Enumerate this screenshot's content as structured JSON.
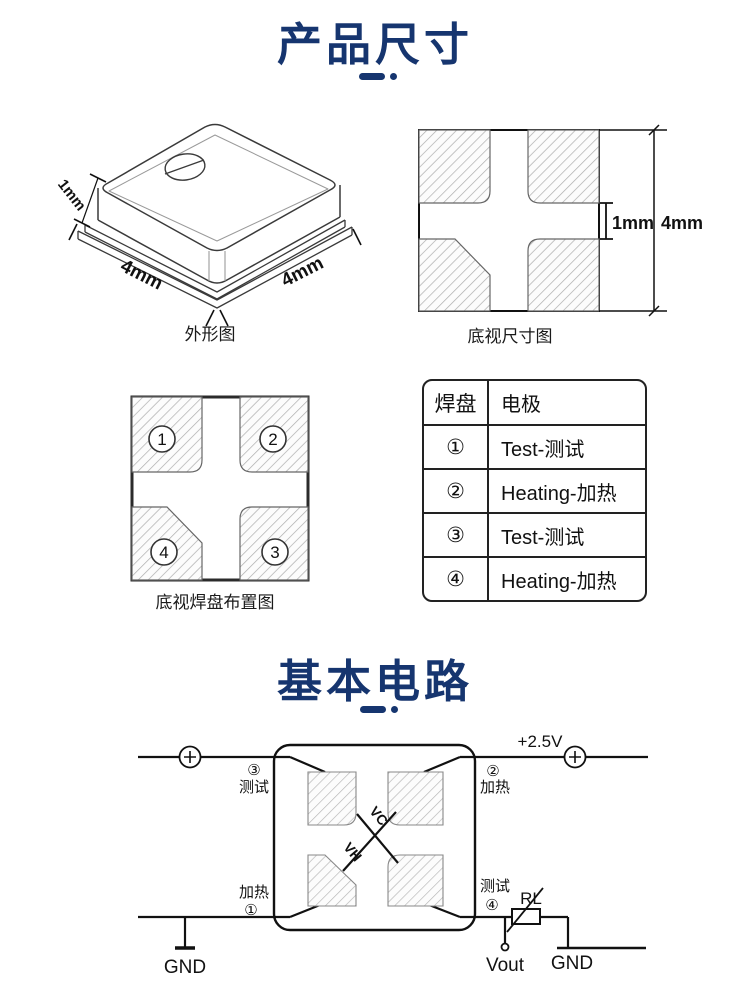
{
  "accent": "#16356f",
  "section1": {
    "title": "产品尺寸"
  },
  "section2": {
    "title": "基本电路"
  },
  "figures": {
    "outline": {
      "caption": "外形图",
      "dim_height": "1mm",
      "dim_left": "4mm",
      "dim_right": "4mm"
    },
    "bottom_view": {
      "caption": "底视尺寸图",
      "dim_gap": "1mm",
      "dim_side": "4mm"
    },
    "pad_layout": {
      "caption": "底视焊盘布置图",
      "pad_tl": "1",
      "pad_tr": "2",
      "pad_bl": "4",
      "pad_br": "3"
    }
  },
  "table": {
    "headers": [
      "焊盘",
      "电极"
    ],
    "rows": [
      {
        "pad": "①",
        "electrode": "Test-测试"
      },
      {
        "pad": "②",
        "electrode": "Heating-加热"
      },
      {
        "pad": "③",
        "electrode": "Test-测试"
      },
      {
        "pad": "④",
        "electrode": "Heating-加热"
      }
    ]
  },
  "circuit": {
    "supply": "+2.5V",
    "pin3_num": "③",
    "pin3_text": "测试",
    "pin2_num": "②",
    "pin2_text": "加热",
    "pin1_num": "①",
    "pin1_text": "加热",
    "pin4_num": "④",
    "pin4_text": "测试",
    "vc": "VC",
    "vh": "VH",
    "rl": "RL",
    "vout": "Vout",
    "gnd_left": "GND",
    "gnd_right": "GND"
  }
}
